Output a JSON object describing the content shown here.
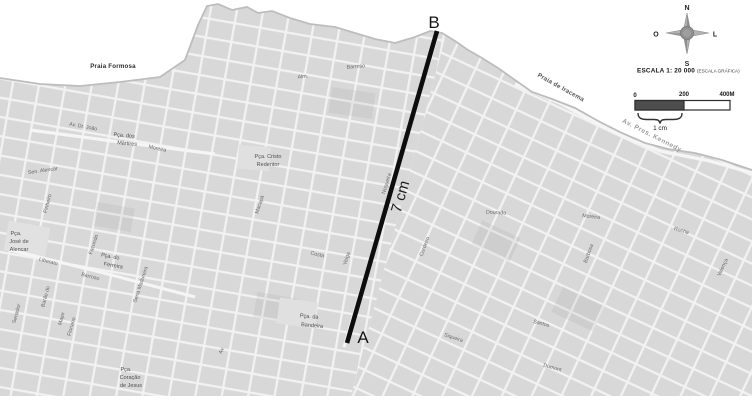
{
  "colors": {
    "sea": "#ffffff",
    "land": "#d8d8d8",
    "street": "#f2f2f2",
    "measure_line": "#111111",
    "scale_bar_fill": "#4d4d4d"
  },
  "map": {
    "beaches": {
      "praia_formosa": "Praia Formosa",
      "praia_de_iracema": "Praia de Iracema"
    },
    "coastal_avenue": "Av. Pres. Kennedy",
    "measurement": {
      "point_a": "A",
      "point_b": "B",
      "distance": "7 cm"
    },
    "squares": {
      "martires_1": "Pça. dos",
      "martires_2": "Mártires",
      "jose_alencar_1": "Pça.",
      "jose_alencar_2": "José de",
      "jose_alencar_3": "Alencar",
      "ferreira_1": "Pça. do",
      "ferreira_2": "Ferreira",
      "cristo_1": "Pça. Cristo",
      "cristo_2": "Redentor",
      "bandeira_1": "Pça. da",
      "bandeira_2": "Bandeira",
      "coracao_1": "Pça.",
      "coracao_2": "Coração",
      "coracao_3": "de Jesus"
    },
    "streets": {
      "av_dr_joao": "Av. Dr. João",
      "moreira_av": "Moreira",
      "sen_alencar": "Sen. Alencar",
      "liberato": "Liberato",
      "barroso": "Barroso",
      "alm": "Alm.",
      "barroso_top": "Barroso",
      "nogueira": "Nogueira",
      "macapa": "Macapá",
      "costa": "Costa",
      "veiga": "Veiga",
      "dourado": "Dourado",
      "moreira": "Moreira",
      "rocha": "Rocha",
      "barbosa": "Barbosa",
      "cordeiro": "Cordeiro",
      "siqueira": "Siqueira",
      "santos": "Santos",
      "dumont": "Dumont",
      "senador": "Senador",
      "barao_do": "Barão do",
      "major": "Major",
      "floriano": "Floriano",
      "facundo": "Facundo",
      "pinheiro": "Pinheiro",
      "sena_madureira": "Sena Madureira",
      "valenca": "Valença",
      "av": "Av."
    }
  },
  "compass": {
    "north": "N",
    "south": "S",
    "east": "L",
    "west": "O"
  },
  "scale": {
    "title": "ESCALA 1: 20 000",
    "subtitle": "(ESCALA GRÁFICA)",
    "tick_0": "0",
    "tick_200": "200",
    "tick_400": "400M",
    "bar_label": "1 cm"
  }
}
